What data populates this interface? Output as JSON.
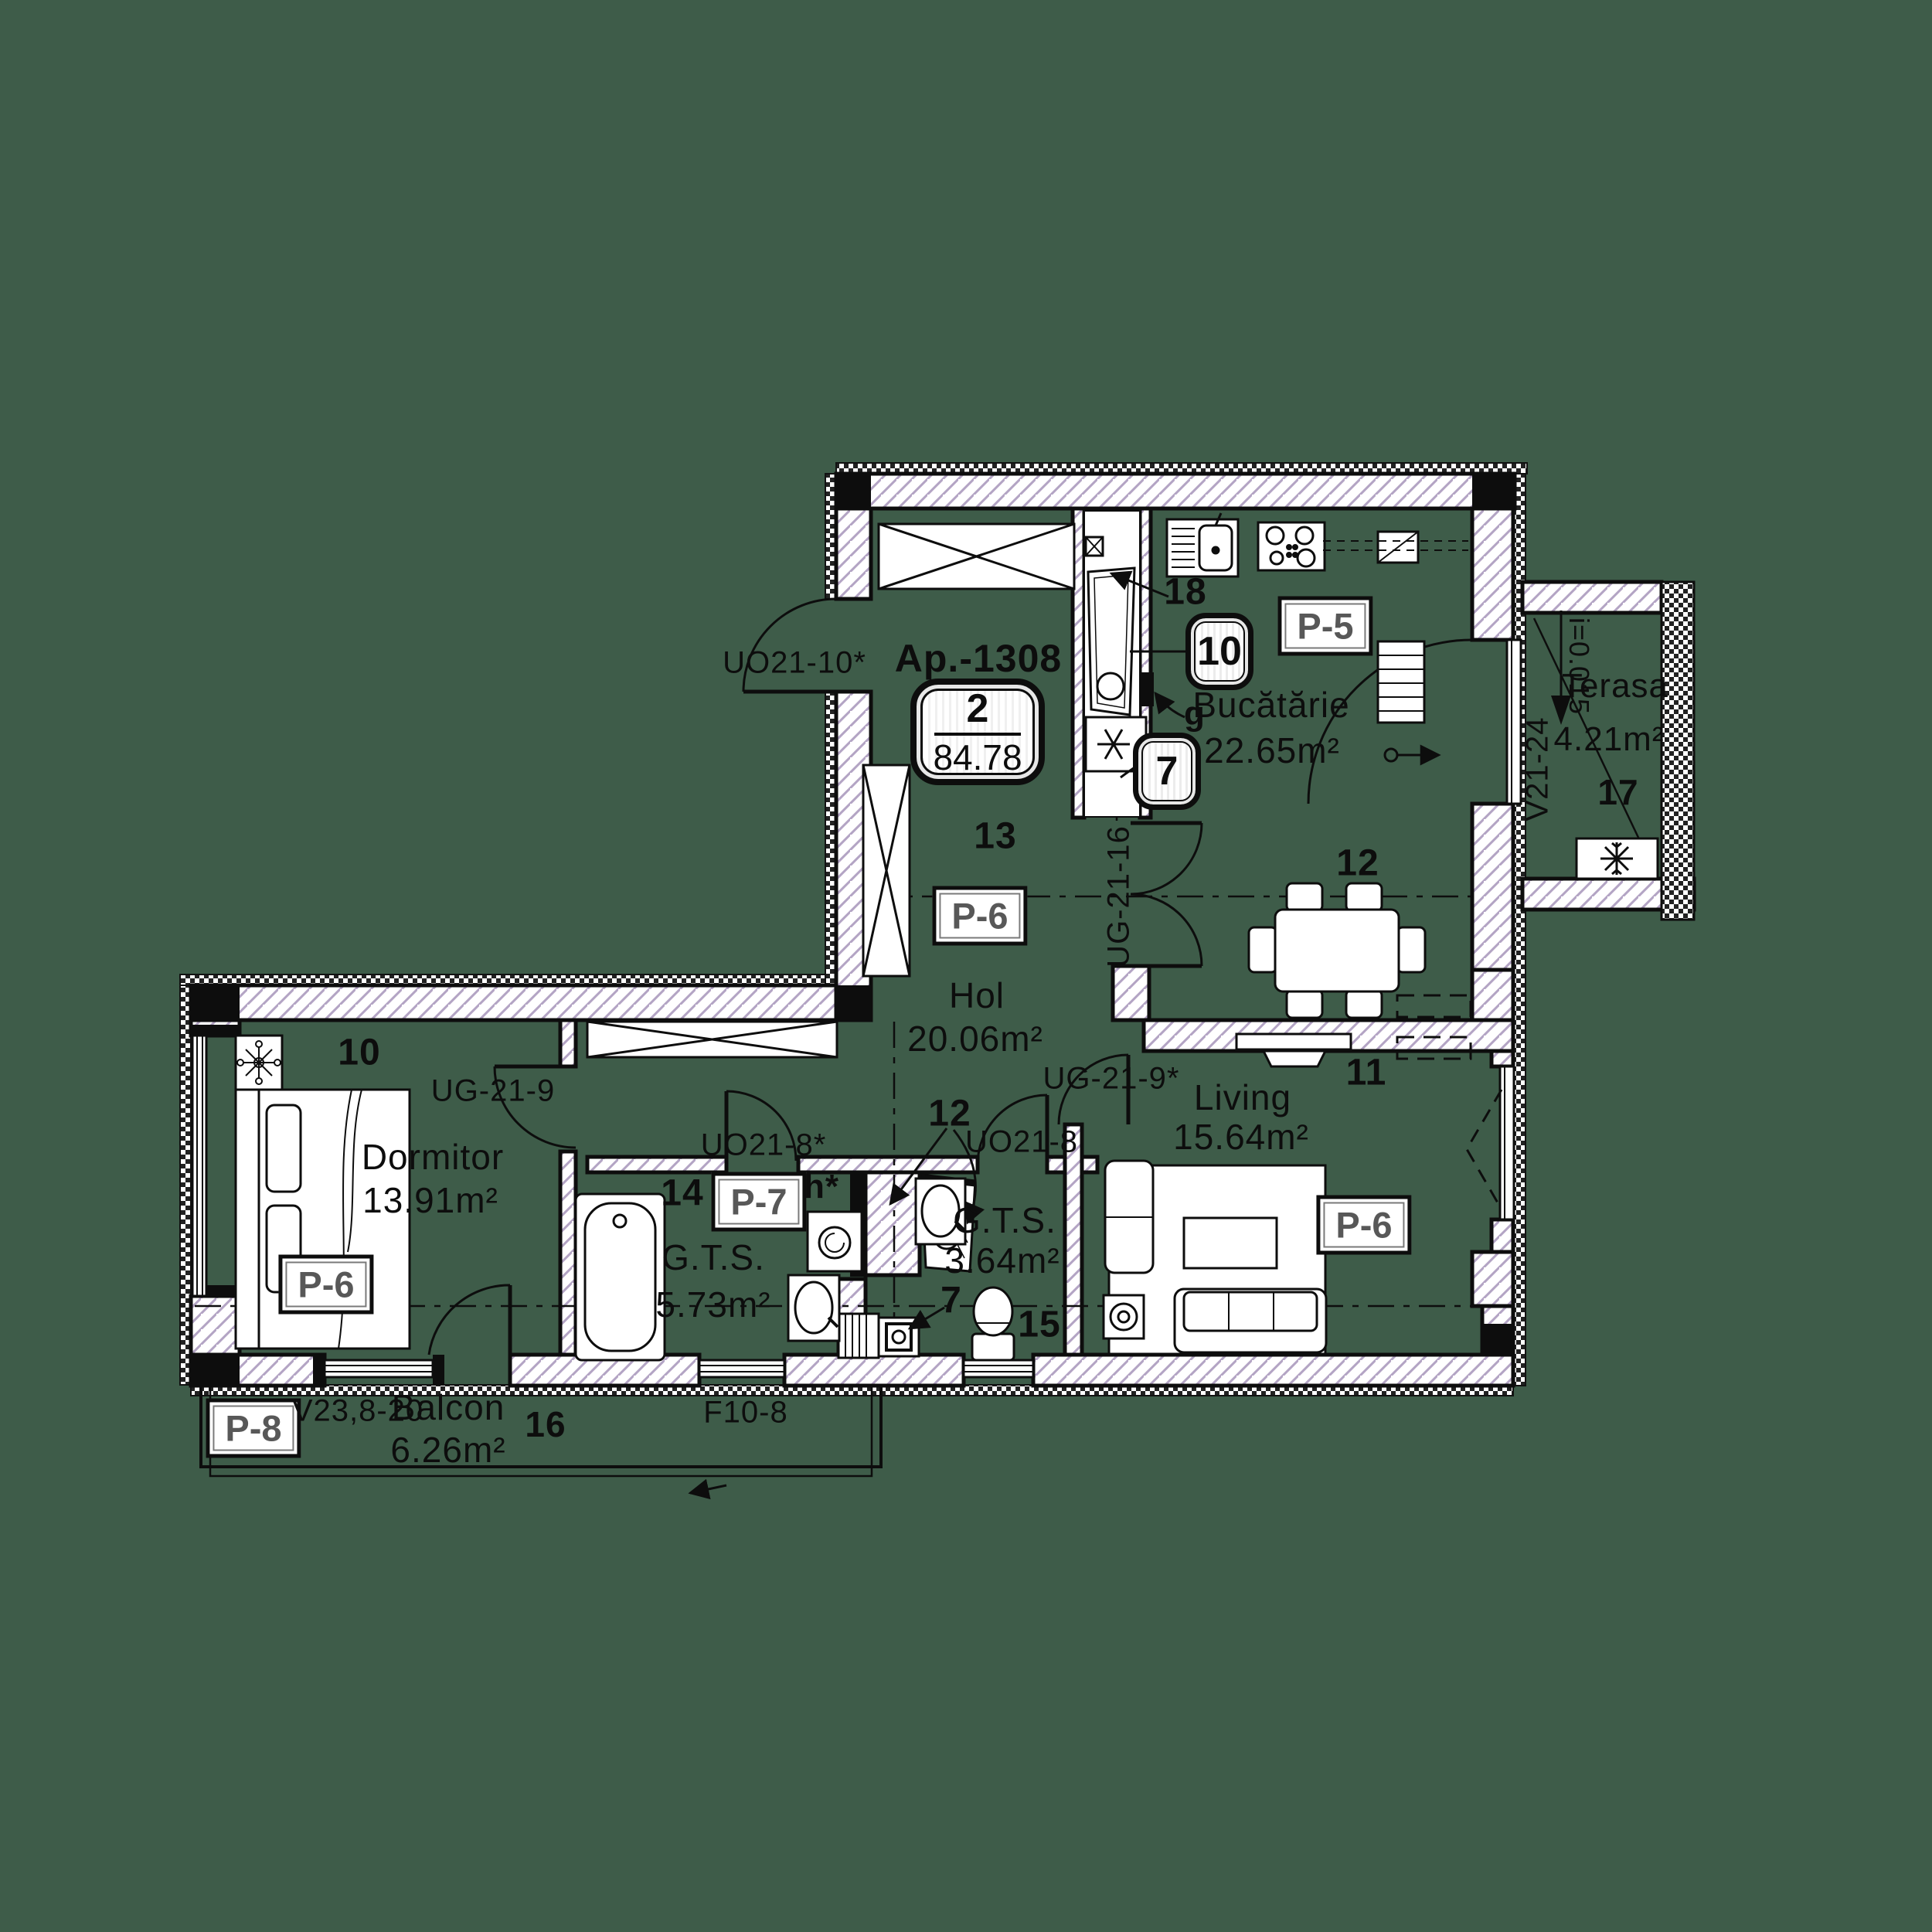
{
  "background_color": "#3e5c49",
  "apartment": {
    "title": "Ap.-1308",
    "rooms_badge": "2",
    "area_badge": "84.78"
  },
  "rooms": {
    "bucatarie": {
      "name": "Bucătărie",
      "area": "22.65m²",
      "number": "12"
    },
    "hol": {
      "name": "Hol",
      "area": "20.06m²",
      "number": "13"
    },
    "dormitor": {
      "name": "Dormitor",
      "area": "13.91m²",
      "number": "10"
    },
    "living": {
      "name": "Living",
      "area": "15.64m²",
      "number": "11"
    },
    "gts1": {
      "name": "G.T.S.",
      "area": "5.73m²",
      "number": "14"
    },
    "gts2": {
      "name": "G.T.S.",
      "area": "3.64m²",
      "number": "15"
    },
    "balcon": {
      "name": "Balcon",
      "area": "6.26m²",
      "number": "16"
    },
    "terasa": {
      "name": "Terasa",
      "area": "4.21m²",
      "number": "17"
    }
  },
  "finish_badges": {
    "bucatarie": "P-5",
    "hol": "P-6",
    "dormitor": "P-6",
    "living": "P-6",
    "gts1": "P-7",
    "balcon": "P-8"
  },
  "openings": {
    "entrance_door": "UO21-10*",
    "kitchen_door": "UG-21-16",
    "dormitor_door": "UG-21-9",
    "living_door": "UG-21-9*",
    "gts1_door": "UO21-8*",
    "gts2_door": "UO21-8",
    "dormitor_balcony_window": "V23,8-20",
    "balcony_window": "F10-8",
    "terasa_window": "V21-24"
  },
  "annotations": {
    "kitchen_shaft_number": "18",
    "riser_badge_kitchen": "10",
    "riser_badge_hall": "7",
    "gas_marker": "g",
    "bath_shaft_number": "12",
    "floor_drain_number": "7",
    "hall_niche_marker": "h*",
    "terasa_slope": "i=0.015"
  }
}
